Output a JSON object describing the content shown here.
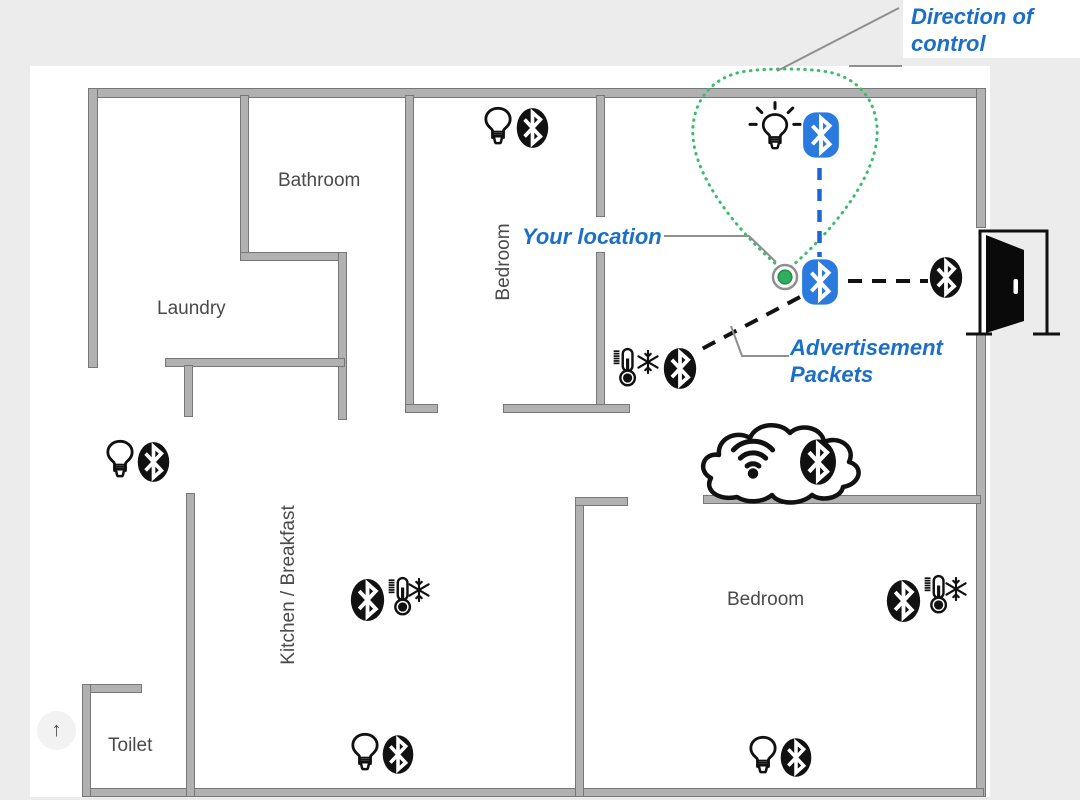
{
  "figure": {
    "description": "Apartment floor plan showing Bluetooth smart-home devices, user location, advertisement packets and direction of control",
    "colors": {
      "page_bg": "#ececec",
      "canvas_bg": "#ffffff",
      "wall_fill": "#b1b1b1",
      "wall_edge": "#777777",
      "annotation_blue": "#1b6fc7",
      "ble_icon_blue": "#2b7ae0",
      "dashed_blue": "#1d66d4",
      "cone_green": "#3bbd6e",
      "location_dot_green": "#2eb05c",
      "device_black": "#111111",
      "room_label_gray": "#4a4a4a"
    }
  },
  "annotations": {
    "direction_of_control": {
      "line1": "Direction of",
      "line2": "control"
    },
    "your_location": {
      "text": "Your location"
    },
    "advertisement_packets": {
      "line1": "Advertisement",
      "line2": "Packets"
    }
  },
  "rooms": {
    "bathroom": "Bathroom",
    "laundry": "Laundry",
    "bedroom_top": "Bedroom",
    "kitchen": "Kitchen / Breakfast",
    "toilet": "Toilet",
    "bedroom_right": "Bedroom"
  },
  "devices": [
    {
      "location": "top-right (controlled)",
      "icons": [
        "shining-light-bulb",
        "bluetooth-blue"
      ]
    },
    {
      "location": "your-location",
      "icons": [
        "green-location-dot",
        "bluetooth-blue"
      ]
    },
    {
      "location": "bedroom-top",
      "icons": [
        "light-bulb",
        "bluetooth"
      ]
    },
    {
      "location": "hallway-left",
      "icons": [
        "light-bulb",
        "bluetooth"
      ]
    },
    {
      "location": "bedroom-top-doorway",
      "icons": [
        "thermostat",
        "snowflake",
        "bluetooth"
      ]
    },
    {
      "location": "near-entry-door",
      "icons": [
        "bluetooth"
      ]
    },
    {
      "location": "gateway-on-wall",
      "icons": [
        "cloud",
        "wifi",
        "bluetooth"
      ]
    },
    {
      "location": "kitchen",
      "icons": [
        "bluetooth",
        "thermostat",
        "snowflake"
      ]
    },
    {
      "location": "bedroom-right",
      "icons": [
        "bluetooth",
        "thermostat",
        "snowflake"
      ]
    },
    {
      "location": "kitchen-bottom",
      "icons": [
        "light-bulb",
        "bluetooth"
      ]
    },
    {
      "location": "bedroom-right-bottom",
      "icons": [
        "light-bulb",
        "bluetooth"
      ]
    }
  ],
  "controls": {
    "scroll_top": "↑"
  }
}
